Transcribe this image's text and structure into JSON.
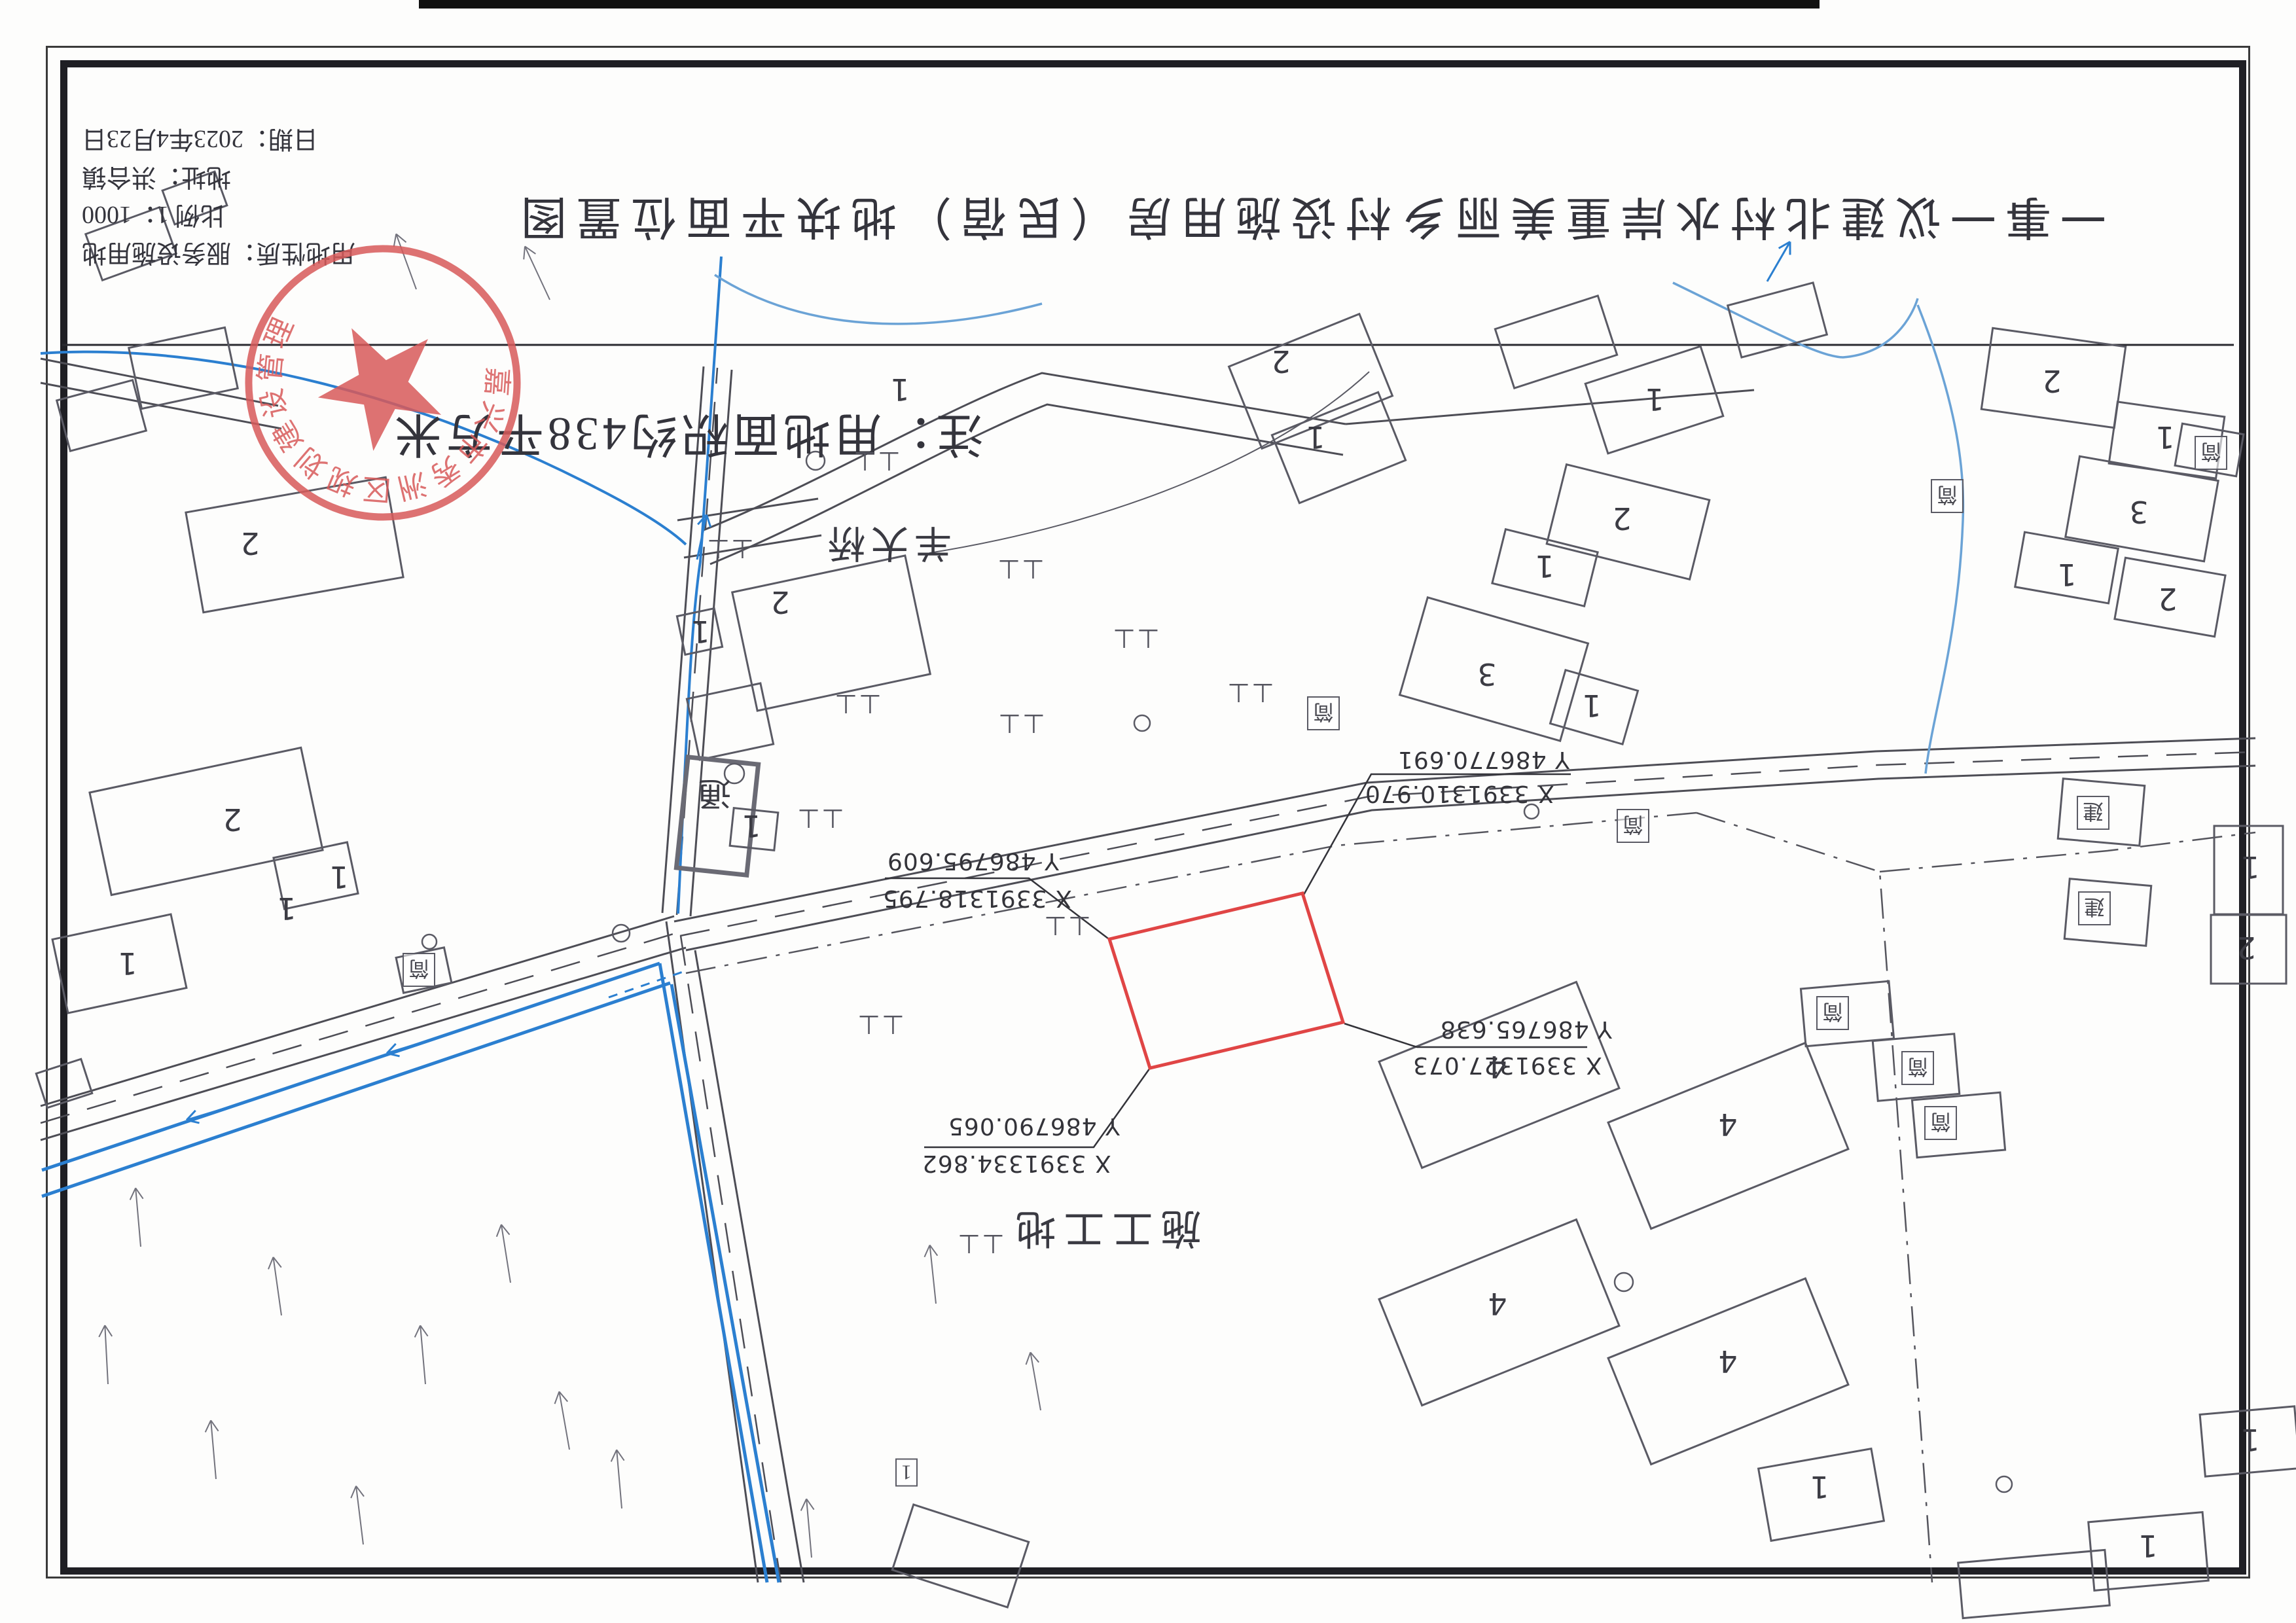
{
  "title": "一事一议建北村水岸重美丽乡村设施用房（民宿）地块平面位置图",
  "note": "注：用地面积约438平方米",
  "info": {
    "lines": [
      "用地性质：服务设施用地",
      "比例 1：1000",
      "地址：洪合镇",
      "日期：2023年4月23日"
    ]
  },
  "stamp": {
    "text": "嘉兴市秀洲区规划建设管理",
    "color": "#d85a5a"
  },
  "site_label": "施工工地",
  "bridge_label": "羊大桥",
  "shed_label": "通",
  "colors": {
    "parcel_red": "#e04545",
    "canal_blue": "#2b7fd0",
    "light_blue": "#6ba3d6",
    "ink": "#4d4d55"
  },
  "coords": [
    {
      "x": "X 3391310.970",
      "y": "Y 486770.691",
      "xp": [
        2085,
        1192
      ],
      "yp": [
        2135,
        1140
      ]
    },
    {
      "x": "X 3391318.795",
      "y": "Y 486795.609",
      "xp": [
        1348,
        1352
      ],
      "yp": [
        1355,
        1295
      ]
    },
    {
      "x": "X 3391327.073",
      "y": "Y 486765.638",
      "xp": [
        2158,
        1607
      ],
      "yp": [
        2200,
        1552
      ]
    },
    {
      "x": "X 3391334.862",
      "y": "Y 486790.065",
      "xp": [
        1408,
        1757
      ],
      "yp": [
        1448,
        1700
      ]
    }
  ],
  "map": {
    "paddy_symbol": "⊥⊥",
    "buildings": [
      [
        140,
        335,
        120,
        75,
        -20
      ],
      [
        255,
        275,
        85,
        55,
        -20
      ],
      [
        205,
        515,
        150,
        95,
        -12
      ],
      [
        95,
        595,
        120,
        80,
        -15
      ],
      [
        295,
        755,
        310,
        155,
        -10
      ],
      [
        150,
        1175,
        330,
        160,
        -12
      ],
      [
        425,
        1298,
        115,
        80,
        -12
      ],
      [
        90,
        1415,
        185,
        115,
        -12
      ],
      [
        610,
        1455,
        75,
        55,
        -12
      ],
      [
        62,
        1628,
        72,
        55,
        -18
      ],
      [
        1135,
        875,
        270,
        185,
        -12
      ],
      [
        1058,
        1055,
        115,
        95,
        -12
      ],
      [
        1040,
        935,
        58,
        60,
        -12
      ],
      [
        1042,
        1162,
        108,
        170,
        6,
        1
      ],
      [
        1118,
        1238,
        68,
        58,
        6
      ],
      [
        1895,
        515,
        215,
        135,
        -22
      ],
      [
        1958,
        628,
        175,
        112,
        -22
      ],
      [
        2295,
        475,
        165,
        95,
        -18
      ],
      [
        2435,
        555,
        185,
        112,
        -18
      ],
      [
        2648,
        448,
        135,
        82,
        -15
      ],
      [
        3035,
        515,
        205,
        125,
        8
      ],
      [
        3228,
        625,
        165,
        95,
        8
      ],
      [
        2375,
        735,
        225,
        125,
        14
      ],
      [
        2288,
        825,
        145,
        85,
        14
      ],
      [
        3165,
        715,
        215,
        125,
        10
      ],
      [
        3238,
        865,
        155,
        95,
        10
      ],
      [
        3085,
        825,
        145,
        85,
        10
      ],
      [
        3328,
        655,
        95,
        65,
        10
      ],
      [
        2155,
        945,
        255,
        155,
        16
      ],
      [
        2378,
        1038,
        115,
        85,
        16
      ],
      [
        3148,
        1195,
        125,
        92,
        5
      ],
      [
        3158,
        1348,
        125,
        92,
        5
      ],
      [
        3383,
        1262,
        105,
        135,
        0
      ],
      [
        3378,
        1398,
        115,
        105,
        0
      ],
      [
        2865,
        1585,
        125,
        92,
        -5
      ],
      [
        2925,
        1675,
        135,
        88,
        -5
      ],
      [
        2755,
        1505,
        135,
        88,
        -5
      ],
      [
        2128,
        1555,
        325,
        175,
        -22
      ],
      [
        2478,
        1648,
        325,
        175,
        -22
      ],
      [
        2128,
        1918,
        325,
        175,
        -22
      ],
      [
        2478,
        2008,
        325,
        175,
        -22
      ],
      [
        2695,
        2228,
        175,
        112,
        -10
      ],
      [
        3195,
        2318,
        175,
        105,
        -5
      ],
      [
        3365,
        2155,
        145,
        95,
        -5
      ],
      [
        2995,
        2378,
        225,
        85,
        -5
      ],
      [
        1375,
        2325,
        185,
        105,
        18
      ]
    ],
    "floor_labels": [
      [
        "2",
        1957,
        552
      ],
      [
        "1",
        2010,
        668
      ],
      [
        "1",
        2528,
        610
      ],
      [
        "2",
        3135,
        582
      ],
      [
        "1",
        3308,
        668
      ],
      [
        "2",
        2478,
        792
      ],
      [
        "1",
        2360,
        865
      ],
      [
        "3",
        3268,
        782
      ],
      [
        "2",
        3312,
        915
      ],
      [
        "1",
        3158,
        878
      ],
      [
        "2",
        382,
        830
      ],
      [
        "2",
        1192,
        920
      ],
      [
        "1",
        1070,
        965
      ],
      [
        "3",
        2272,
        1030
      ],
      [
        "1",
        2432,
        1078
      ],
      [
        "2",
        355,
        1252
      ],
      [
        "1",
        518,
        1340
      ],
      [
        "1",
        438,
        1388
      ],
      [
        "1",
        195,
        1472
      ],
      [
        "4",
        2288,
        1630
      ],
      [
        "4",
        2640,
        1718
      ],
      [
        "4",
        2288,
        1992
      ],
      [
        "4",
        2640,
        2080
      ],
      [
        "1",
        2780,
        2272
      ],
      [
        "1",
        3282,
        2362
      ],
      [
        "1",
        3438,
        2200
      ],
      [
        "1",
        1148,
        1262
      ],
      [
        "1",
        1375,
        595
      ],
      [
        "1",
        3438,
        1325
      ],
      [
        "2",
        3432,
        1448
      ]
    ],
    "tag_labels": [
      [
        "简",
        2022,
        1090
      ],
      [
        "简",
        2975,
        758
      ],
      [
        "简",
        2495,
        1262
      ],
      [
        "简",
        2800,
        1548
      ],
      [
        "简",
        2930,
        1632
      ],
      [
        "简",
        2965,
        1716
      ],
      [
        "简",
        3378,
        692
      ],
      [
        "建",
        3198,
        1242
      ],
      [
        "建",
        3200,
        1388
      ],
      [
        "简",
        640,
        1482
      ],
      [
        "1",
        1385,
        2250
      ]
    ],
    "paddy": [
      [
        1115,
        838
      ],
      [
        1310,
        1075
      ],
      [
        1253,
        1250
      ],
      [
        1560,
        1105
      ],
      [
        1735,
        975
      ],
      [
        1559,
        869
      ],
      [
        1910,
        1058
      ],
      [
        1339,
        704
      ],
      [
        1345,
        1565
      ],
      [
        1630,
        1414
      ],
      [
        1498,
        1900
      ]
    ],
    "gray_arrows": [
      [
        215,
        1905,
        -95
      ],
      [
        430,
        2010,
        -98
      ],
      [
        650,
        2115,
        -95
      ],
      [
        870,
        2215,
        -100
      ],
      [
        330,
        2260,
        -95
      ],
      [
        555,
        2360,
        -97
      ],
      [
        165,
        2115,
        -93
      ],
      [
        780,
        1960,
        -99
      ],
      [
        950,
        2305,
        -95
      ],
      [
        1590,
        2155,
        -100
      ],
      [
        1430,
        1992,
        -96
      ],
      [
        840,
        458,
        -115
      ],
      [
        636,
        442,
        -110
      ],
      [
        1240,
        2380,
        -95
      ]
    ],
    "blue_arrows": [
      [
        352,
        1691,
        163
      ],
      [
        658,
        1589,
        163
      ],
      [
        1065,
        855,
        -78
      ],
      [
        2700,
        430,
        -60
      ]
    ],
    "circles": [
      [
        949,
        1426,
        13
      ],
      [
        656,
        1439,
        11
      ],
      [
        1246,
        704,
        14
      ],
      [
        1122,
        1182,
        15
      ],
      [
        2481,
        1959,
        14
      ],
      [
        3062,
        2268,
        12
      ],
      [
        1745,
        1105,
        12
      ],
      [
        2340,
        1240,
        11
      ]
    ]
  }
}
